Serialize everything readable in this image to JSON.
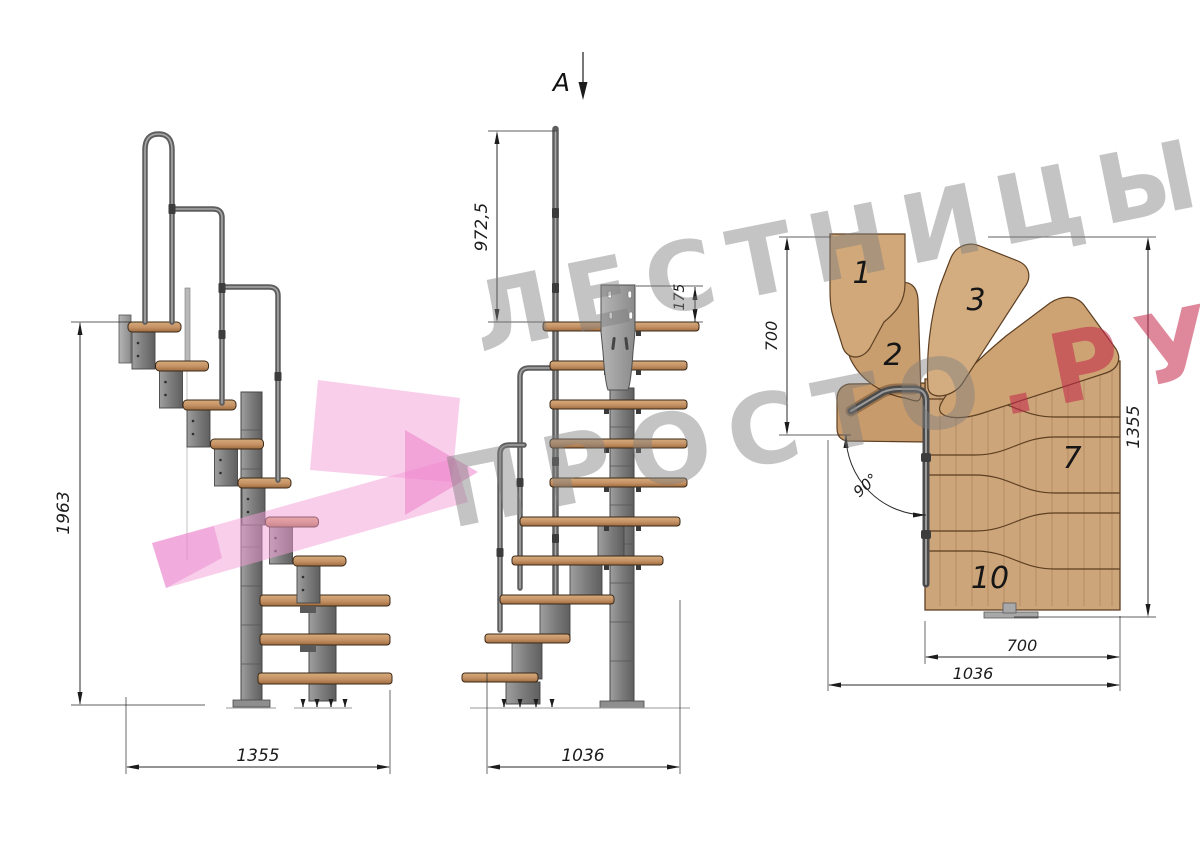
{
  "watermark": {
    "brand_line1": "ЛЕСТНИЦЫ",
    "brand_line2_gray": "ПРОСТО",
    "brand_line2_accent": ".РУ",
    "text_color": "#9a9a9a",
    "accent_color": "#c52648",
    "logo_color": "#f2a8da"
  },
  "section_marker": {
    "label": "A"
  },
  "side_view": {
    "name": "side-elevation",
    "dim_total_height": "1963",
    "dim_total_length": "1355"
  },
  "front_view": {
    "name": "front-elevation",
    "dim_handrail_height": "972,5",
    "dim_mount_plate": "175",
    "dim_total_width": "1036"
  },
  "plan_view": {
    "name": "plan-view",
    "dim_upper_flight_depth": "700",
    "dim_overall_length": "1355",
    "dim_lower_flight_width": "700",
    "dim_overall_width": "1036",
    "dim_turn_angle": "90°",
    "tread_labels": {
      "t1": "1",
      "t2": "2",
      "t3": "3",
      "t7": "7",
      "t10": "10"
    }
  }
}
